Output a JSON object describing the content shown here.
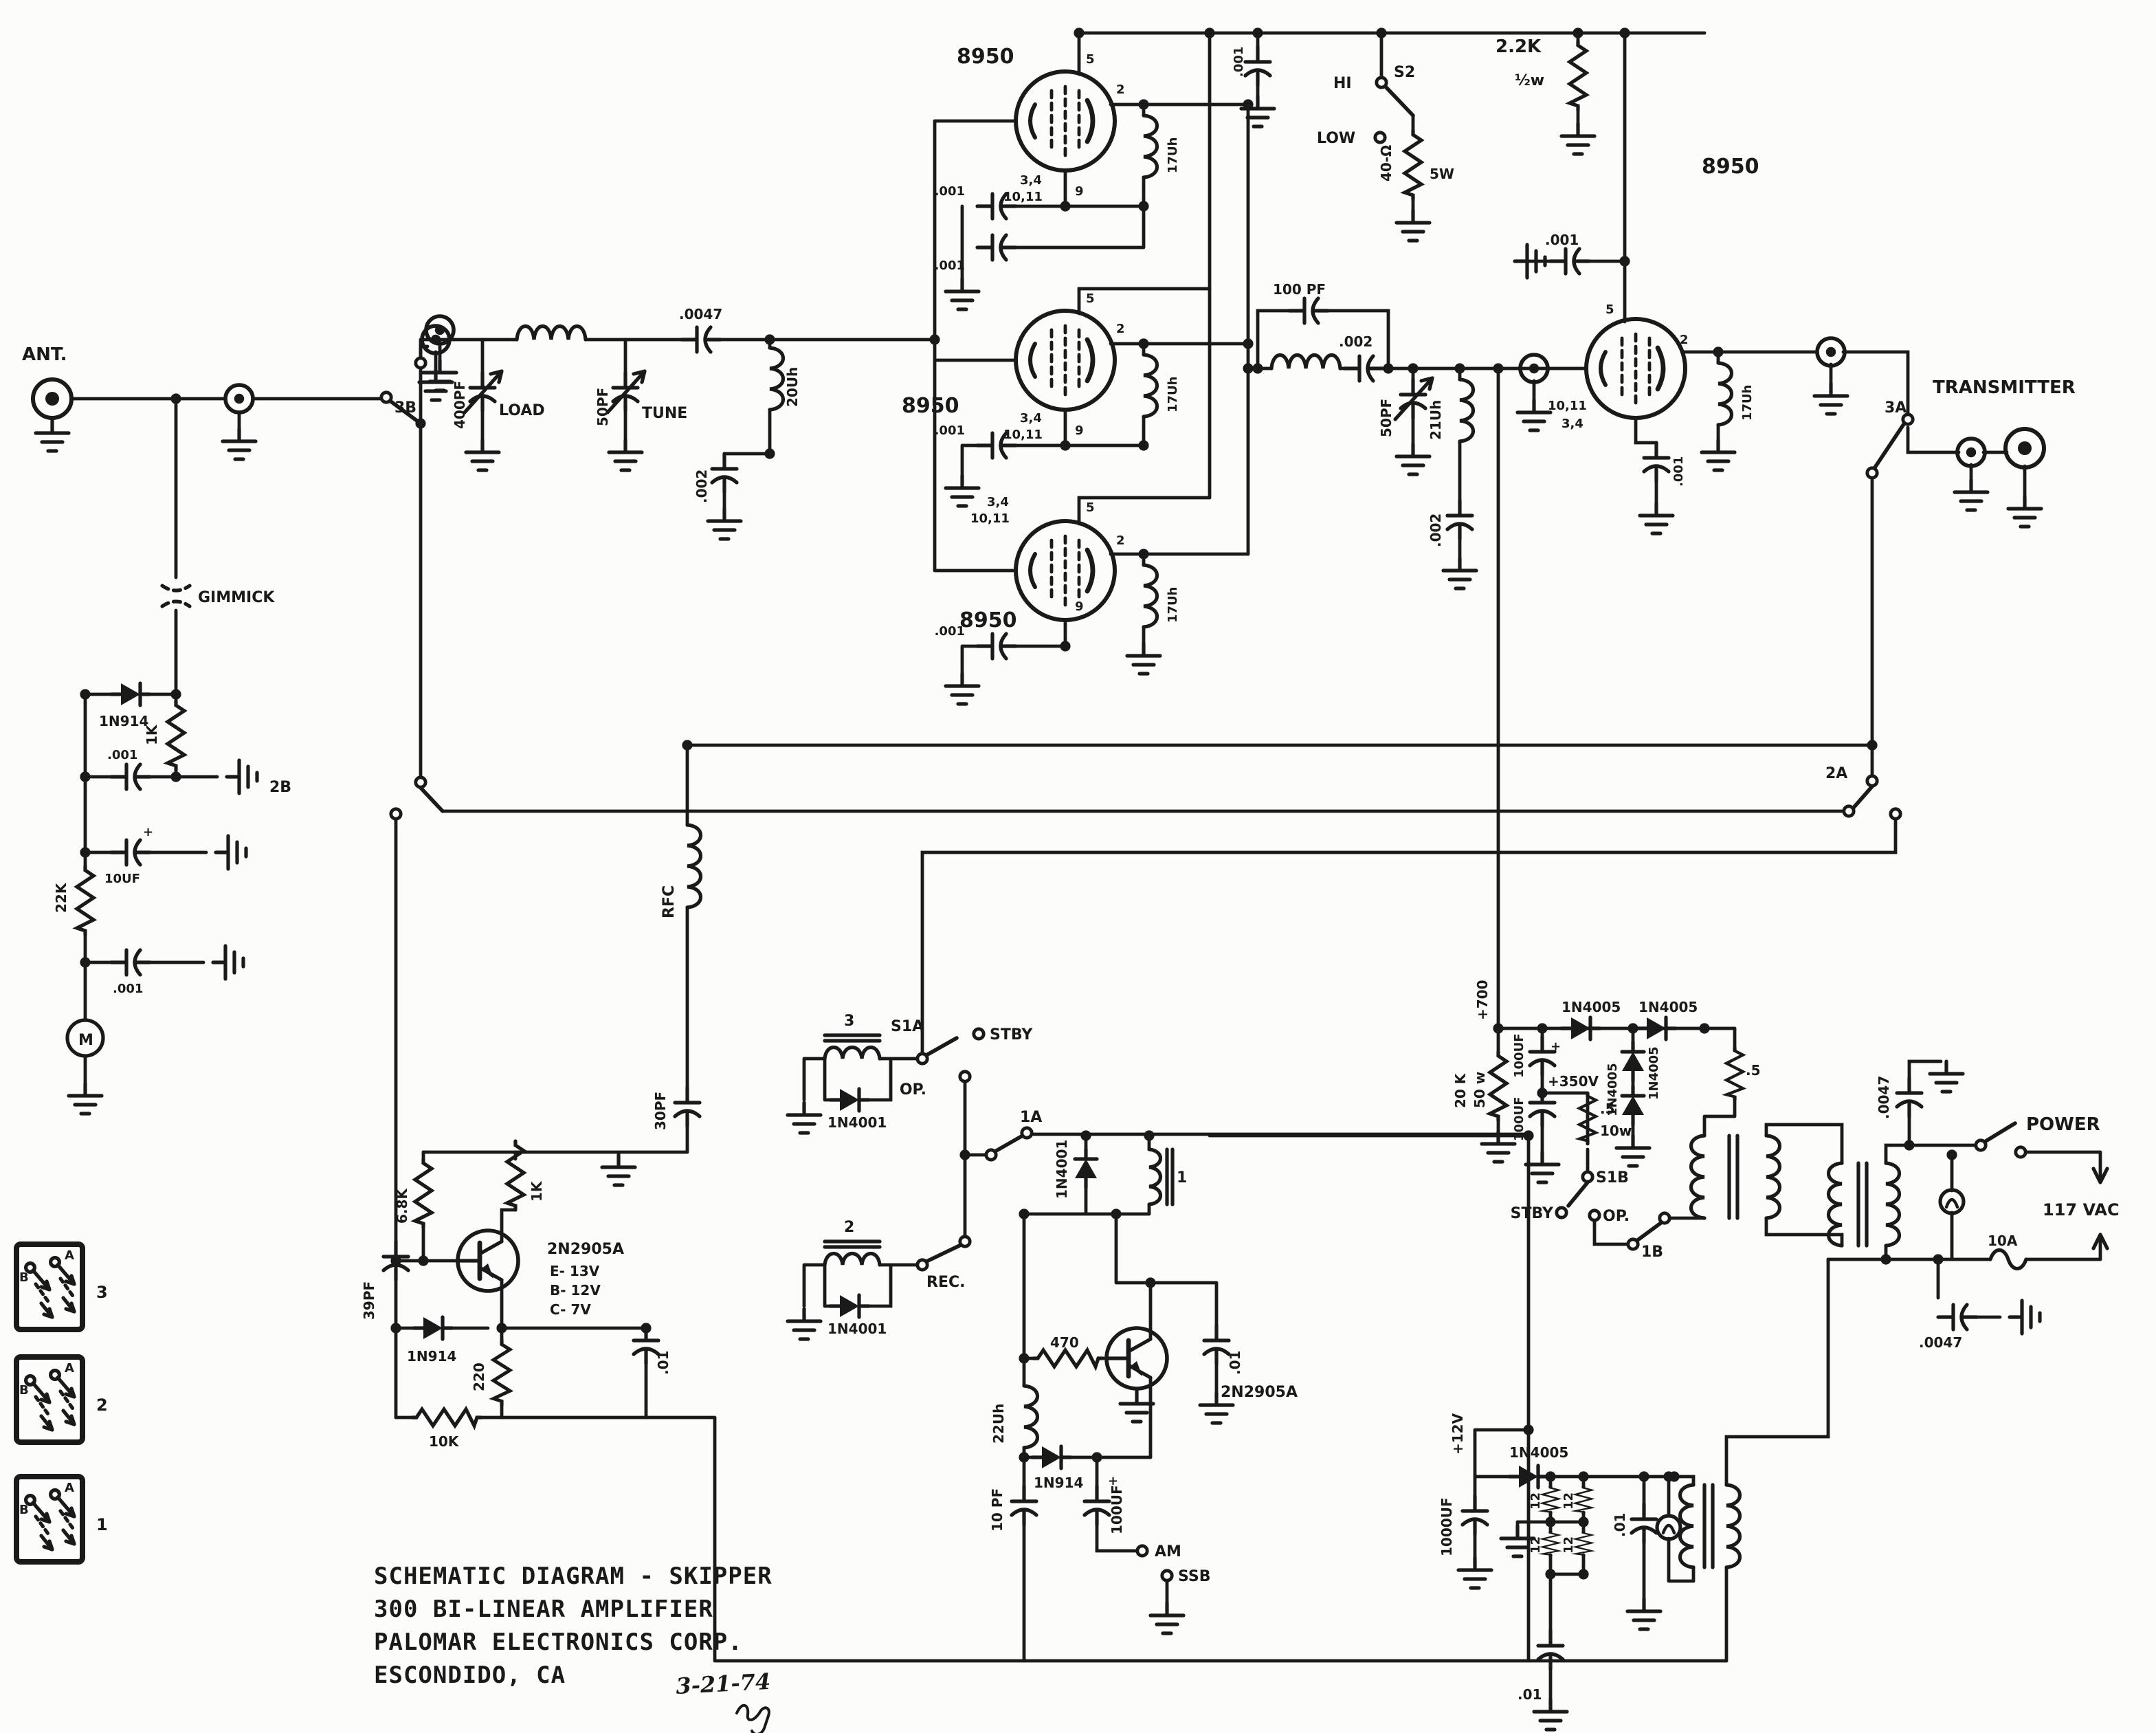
{
  "document": {
    "type": "scanned schematic diagram",
    "ink_color": "#1a1a1a",
    "paper_color": "#fcfcfa"
  },
  "title_block": {
    "line1": "SCHEMATIC DIAGRAM - SKIPPER",
    "line2": "300 BI-LINEAR AMPLIFIER",
    "line3": "PALOMAR ELECTRONICS CORP.",
    "line4": "ESCONDIDO, CA",
    "date": "3-21-74"
  },
  "labels": {
    "ant": "ANT.",
    "transmitter": "TRANSMITTER",
    "gimmick": "GIMMICK",
    "d1n914": "1N914",
    "d1n4001": "1N4001",
    "d1n4005": "1N4005",
    "q2n2905a": "2N2905A",
    "e_volt": "E- 13V",
    "b_volt": "B- 12V",
    "c_volt": "C- 7V",
    "tube8950": "8950",
    "pin5": "5",
    "pin2": "2",
    "pin9": "9",
    "pins34": "3,4",
    "pins1011": "10,11",
    "l17uh": "17Uh",
    "l20uh": "20Uh",
    "l21uh": "21Uh",
    "l22uh": "22Uh",
    "rfc": "RFC",
    "c001": ".001",
    "c002": ".002",
    "c0047": ".0047",
    "c01": ".01",
    "c100pf": "100 PF",
    "c400pf": "400PF",
    "c50pf": "50PF",
    "c39pf": "39PF",
    "c30pf": "30PF",
    "c10pf": "10 PF",
    "c10uf": "10UF",
    "c100uf": "100UF",
    "c1000uf": "1000UF",
    "r1k": "1K",
    "r22k": "22K",
    "r2_2k": "2.2K",
    "half_w": "½w",
    "r40ohm": "40-Ω",
    "w5": "5W",
    "r6_8k": "6.8K",
    "r220": "220",
    "r10k": "10K",
    "r470": "470",
    "r20k": "20 K",
    "w50": "50 w",
    "r_5": ".5",
    "w10": "10w",
    "r12": "12",
    "load": "LOAD",
    "tune": "TUNE",
    "hi": "HI",
    "low": "LOW",
    "s2": "S2",
    "s1a": "S1A",
    "s1b": "S1B",
    "stby": "STBY",
    "op": "OP.",
    "rec": "REC.",
    "am": "AM",
    "ssb": "SSB",
    "sw1a": "1A",
    "sw1b": "1B",
    "sw2a": "2A",
    "sw2b": "2B",
    "sw3a": "3A",
    "sw3b": "3B",
    "meter": "M",
    "p700": "+700",
    "p350": "+350V",
    "p12": "+12V",
    "vac117": "117 VAC",
    "f10a": "10A",
    "power": "POWER",
    "relay1": "1",
    "relay2": "2",
    "relay3": "3",
    "legA": "A",
    "legB": "B",
    "plus": "+"
  }
}
